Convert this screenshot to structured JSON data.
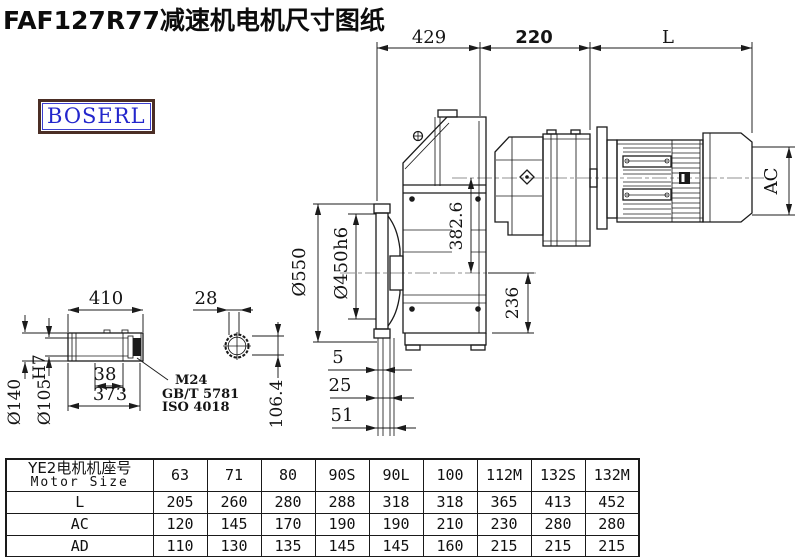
{
  "title": "FAF127R77减速机电机尺寸图纸",
  "logo": "BOSERL",
  "dims": {
    "top_429": "429",
    "top_220": "220",
    "top_L": "L",
    "ac": "AC",
    "d550": "Ø550",
    "d450": "Ø450",
    "d450_suffix": "h6",
    "v382": "382.6",
    "v236": "236",
    "shaft_410": "410",
    "shaft_38": "38",
    "shaft_373": "373",
    "d140": "Ø140",
    "d105": "Ø105",
    "d105_sup": "H7",
    "note_m24": "M24",
    "note_gbt": "GB/T 5781",
    "note_iso": "ISO 4018",
    "c28": "28",
    "c106": "106.4",
    "s5": "5",
    "s25": "25",
    "s51": "51"
  },
  "table": {
    "header_cn": "YE2电机机座号",
    "header_en": "Motor Size",
    "columns": [
      "63",
      "71",
      "80",
      "90S",
      "90L",
      "100",
      "112M",
      "132S",
      "132M"
    ],
    "rows": [
      {
        "label": "L",
        "values": [
          "205",
          "260",
          "280",
          "288",
          "318",
          "318",
          "365",
          "413",
          "452"
        ]
      },
      {
        "label": "AC",
        "values": [
          "120",
          "145",
          "170",
          "190",
          "190",
          "210",
          "230",
          "280",
          "280"
        ]
      },
      {
        "label": "AD",
        "values": [
          "110",
          "130",
          "135",
          "145",
          "145",
          "160",
          "215",
          "215",
          "215"
        ]
      }
    ]
  }
}
